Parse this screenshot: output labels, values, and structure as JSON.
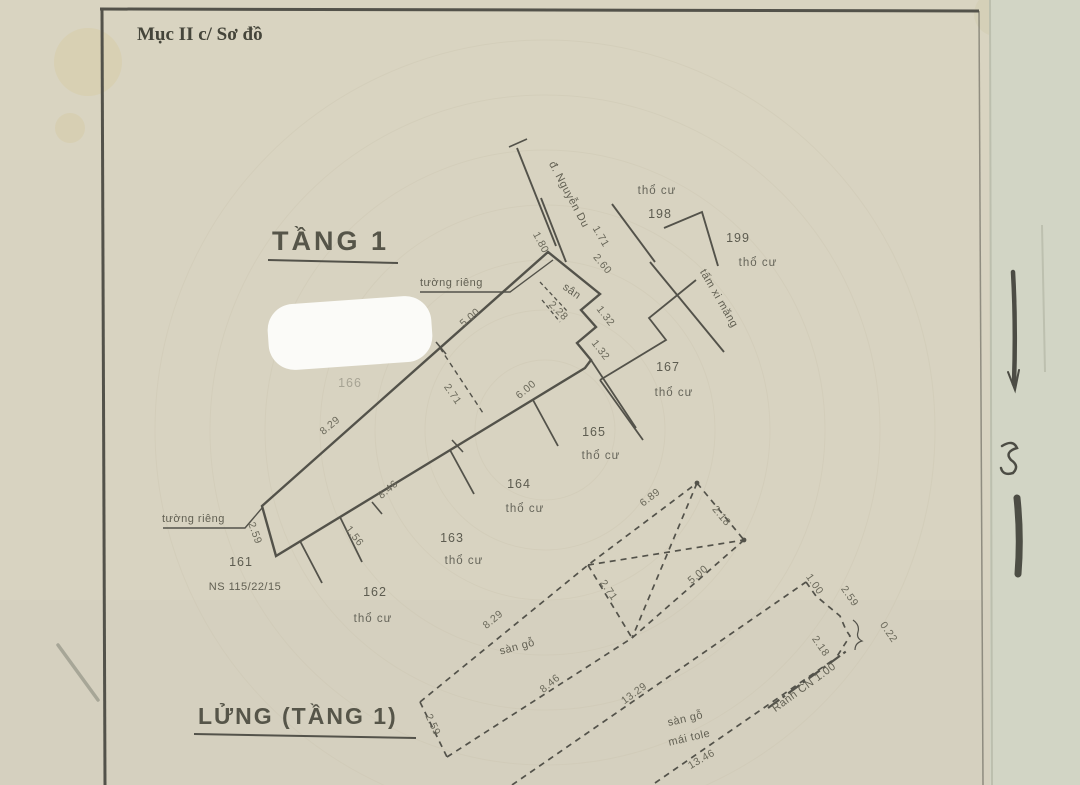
{
  "document": {
    "header": "Mục II c/ Sơ đồ",
    "floor1": {
      "title": "TẦNG 1",
      "wall_top": "tường riêng",
      "wall_left": "tường riêng",
      "street": "đ. Nguyễn Du",
      "cement_panel": "tấm xi măng",
      "yard": "sân",
      "house_number": "NS 115/22/15",
      "land_type": "thổ cư",
      "parcels": {
        "p198": "198",
        "p199": "199",
        "p167": "167",
        "p166": "166",
        "p165": "165",
        "p164": "164",
        "p163": "163",
        "p162": "162",
        "p161": "161"
      },
      "dims": {
        "d829": "8.29",
        "d500": "5.00",
        "d180": "1.80",
        "d171": "1.71",
        "d260": "2.60",
        "d228": "2.28",
        "d132a": "1.32",
        "d132b": "1.32",
        "d271": "2.71",
        "d600": "6.00",
        "d846": "8.46",
        "d156": "1.56",
        "d259": "2.59"
      }
    },
    "mezzanine": {
      "title": "LỬNG (TẦNG 1)",
      "wood_floor": "sàn gỗ",
      "wood_floor_2": "sàn gỗ",
      "roof": "mái tole",
      "boundary_note": "Ranh CN 1.00",
      "dims": {
        "d829": "8.29",
        "d846": "8.46",
        "d271": "2.71",
        "d259l": "2.59",
        "d689": "6.89",
        "d218a": "2.18",
        "d500": "5.00",
        "d100": "1.00",
        "d259r": "2.59",
        "d022": "0.22",
        "d218b": "2.18",
        "d1329": "13.29",
        "d1346": "13.46"
      }
    }
  }
}
